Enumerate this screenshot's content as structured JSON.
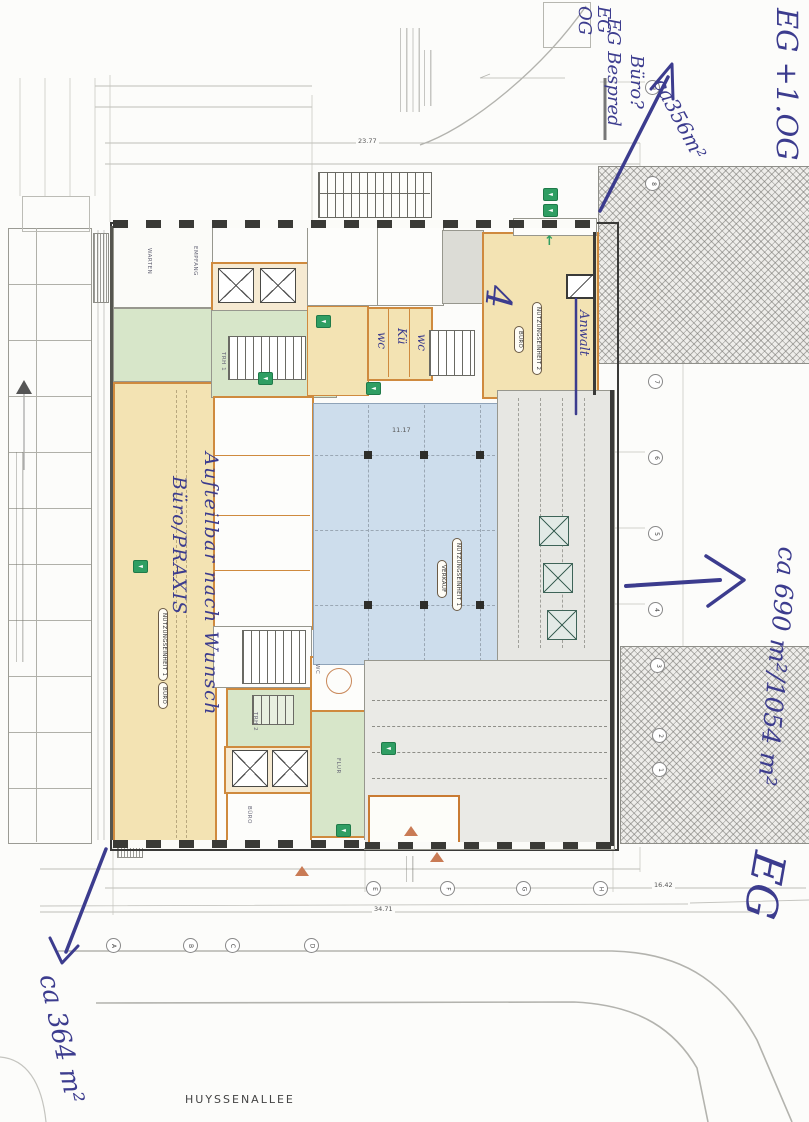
{
  "street": {
    "name": "HUYSSENALLEE"
  },
  "handwriting": {
    "floors_top_right": "EG +1.OG",
    "area_top_right": "ca356m²",
    "note_box_line1": "EG",
    "note_box_line2": "OG",
    "note_q_line1": "EG Bespred",
    "note_q_line2": "Büro?",
    "room_note": "Anwalt",
    "mark": "4",
    "wc_left": "wc",
    "kitchen": "Kü",
    "wc_right": "wc",
    "area_right": "ca 690 m²/1054 m²",
    "floor_right": "EG",
    "area_bottom_left": "ca 364 m²",
    "flexibility_note": "Aufteilbar nach Wunsch",
    "use_note": "Büro/PRAXIS"
  },
  "plan_labels": {
    "unit1": "NUTZUNGSEINHEIT 1",
    "unit1_use": "BÜRO",
    "hall_unit": "NUTZUNGSEINHEIT 1",
    "hall_use": "VERKAUF",
    "unit2": "NUTZUNGSEINHEIT 2",
    "unit2_use": "BÜRO",
    "warten": "WARTEN",
    "empfang": "EMPFANG",
    "trh1": "TRH 1",
    "trh2": "TRH 2",
    "flur": "FLUR",
    "wc": "WC",
    "buero_bottom": "BÜRO"
  },
  "dimensions": {
    "top": "23.77",
    "hall": "11.17",
    "bottom": "34.71",
    "bottom_right": "16.42"
  },
  "grid": {
    "bottom_letters": [
      "A",
      "B",
      "C",
      "D"
    ],
    "inline_letters": [
      "E",
      "F",
      "G",
      "H"
    ],
    "right_numbers": [
      "9",
      "8",
      "7",
      "6",
      "5",
      "4",
      "3",
      "2",
      "1"
    ]
  },
  "icons": {
    "exit_arrow": "◄",
    "exit_up": "↑"
  },
  "colors": {
    "ink": "#3c3c8e",
    "tan_room": "#f3e3b3",
    "green_room": "#d7e6c9",
    "blue_hall": "#cdddec",
    "orange_wall": "#cf8a3e",
    "exit_green": "#2f9e63"
  }
}
